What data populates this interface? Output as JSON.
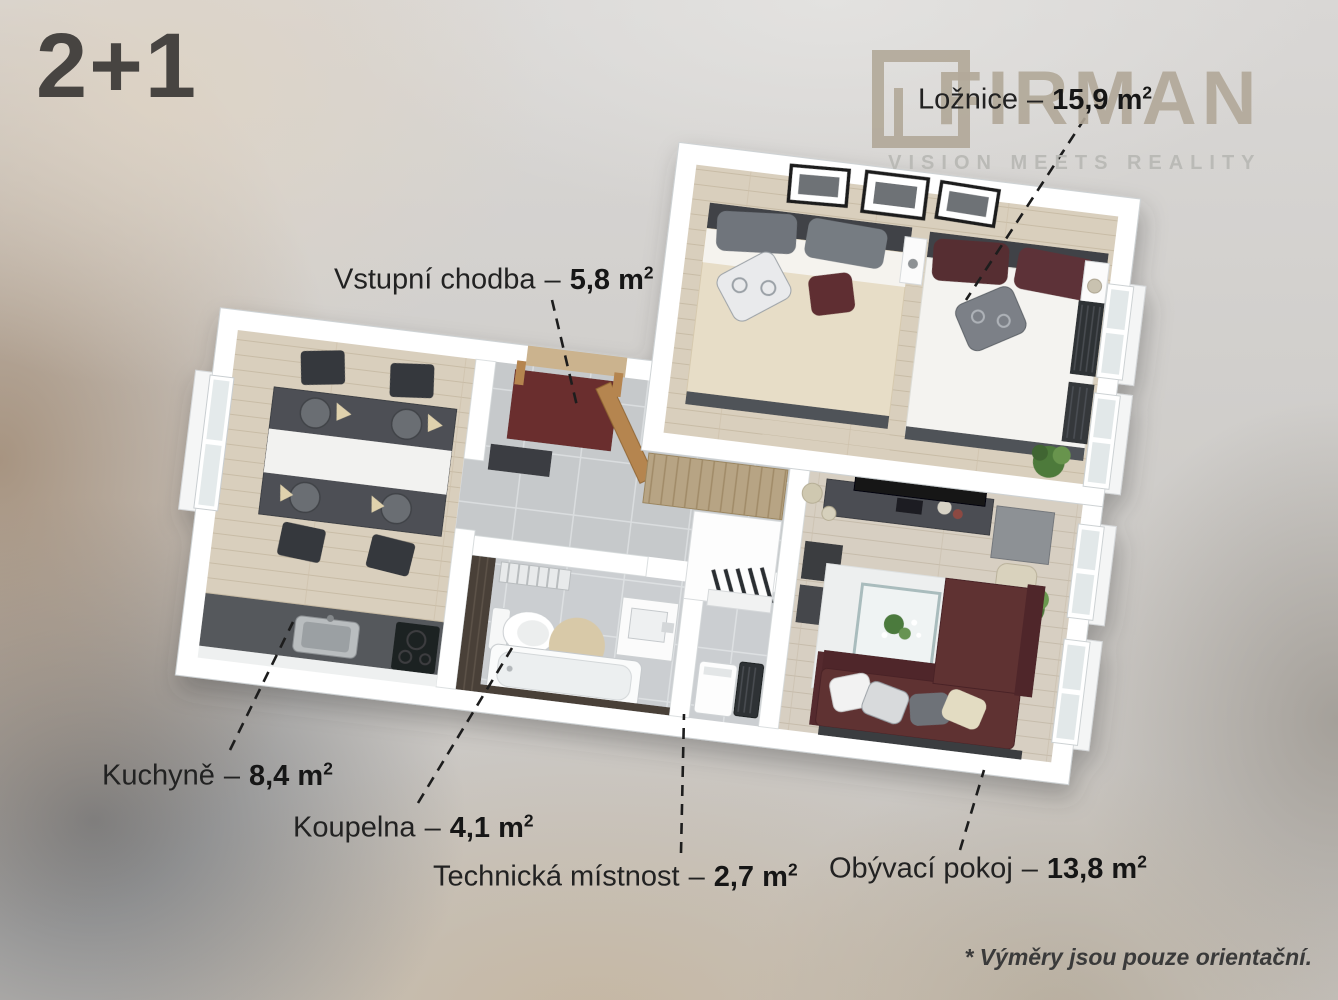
{
  "title": "2+1",
  "logo": {
    "name": "FIRMAN",
    "tagline": "VISION MEETS REALITY"
  },
  "footnote": "* Výměry jsou pouze orientační.",
  "units": {
    "sep": "–",
    "m": "m",
    "sup": "2"
  },
  "rooms": [
    {
      "id": "loznice",
      "name": "Ložnice",
      "area": "15,9"
    },
    {
      "id": "vstupni-chodba",
      "name": "Vstupní chodba",
      "area": "5,8"
    },
    {
      "id": "kuchyne",
      "name": "Kuchyně",
      "area": "8,4"
    },
    {
      "id": "koupelna",
      "name": "Koupelna",
      "area": "4,1"
    },
    {
      "id": "technicka-mistnost",
      "name": "Technická místnost",
      "area": "2,7"
    },
    {
      "id": "obyvaci-pokoj",
      "name": "Obývací pokoj",
      "area": "13,8"
    }
  ],
  "colors": {
    "wall": "#ffffff",
    "wood_floor": "#d9cfbd",
    "tile_floor": "#c6c9cb",
    "sofa": "#5f3133",
    "logo_taupe": "#b1a898",
    "label_text": "#222222",
    "title_text": "#474441"
  }
}
